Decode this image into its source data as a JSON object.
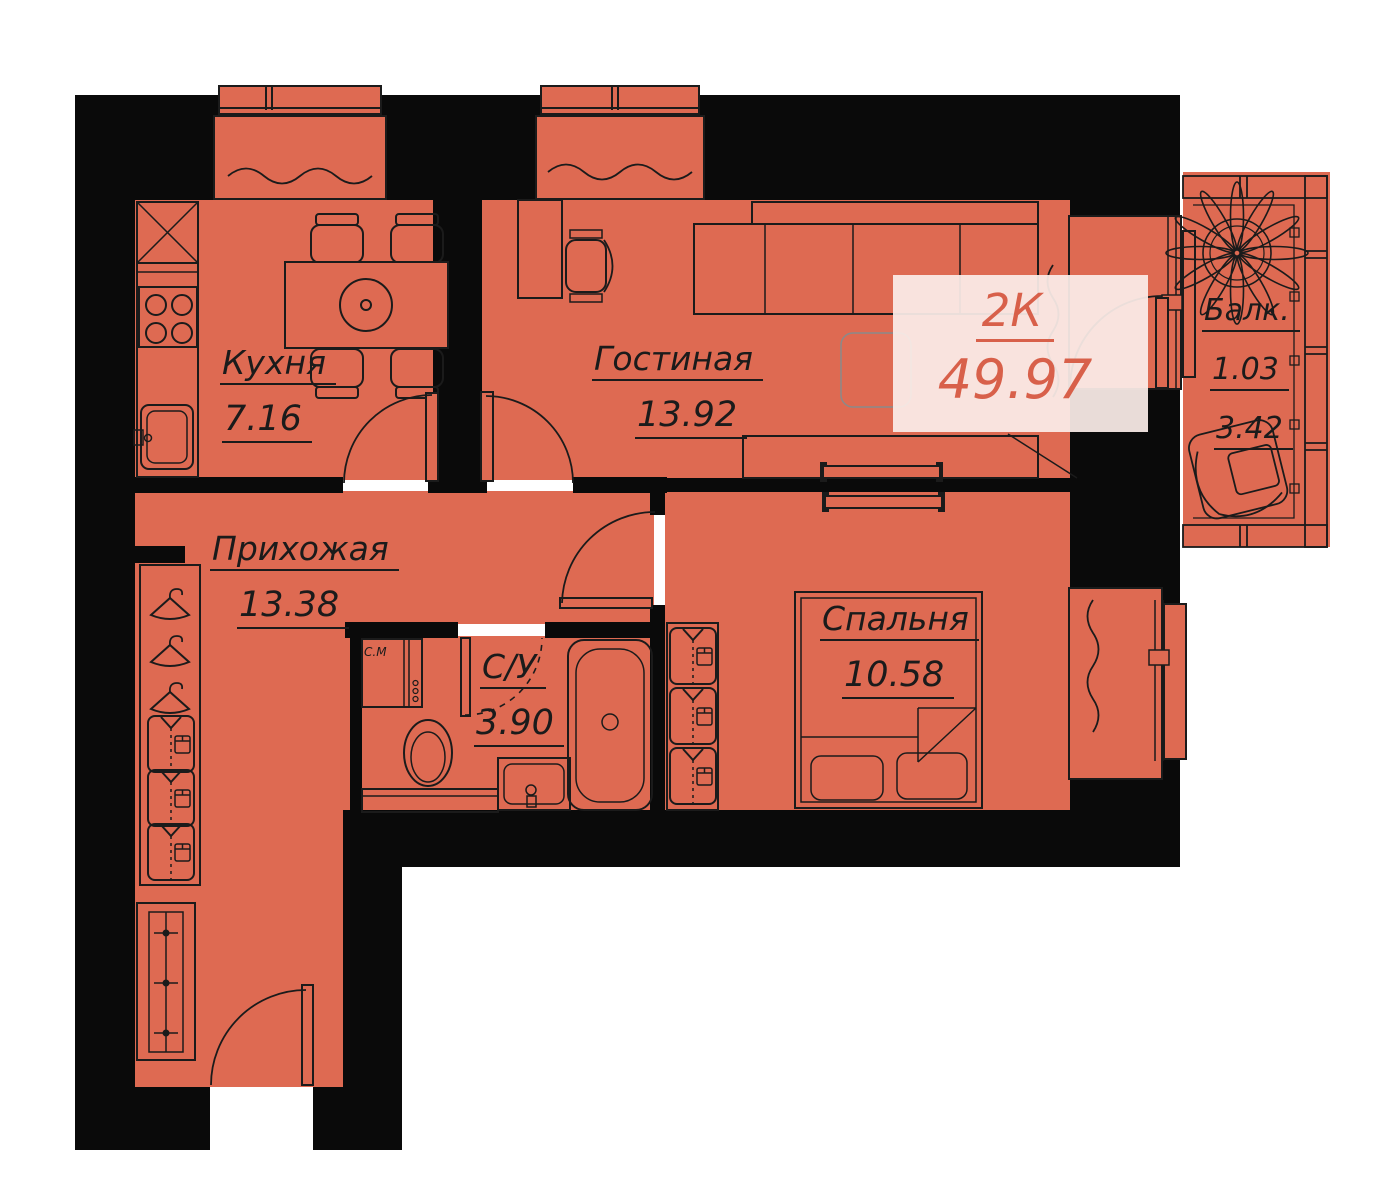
{
  "plan": {
    "unit": {
      "type_label": "2К",
      "total_area": "49.97"
    },
    "rooms": {
      "kitchen": {
        "name": "Кухня",
        "area": "7.16"
      },
      "living": {
        "name": "Гостиная",
        "area": "13.92"
      },
      "hallway": {
        "name": "Прихожая",
        "area": "13.38"
      },
      "bathroom": {
        "name": "С/У",
        "area": "3.90"
      },
      "bedroom": {
        "name": "Спальня",
        "area": "10.58"
      },
      "balcony": {
        "name": "Балк.",
        "reduced_area": "1.03",
        "full_area": "3.42"
      }
    },
    "appliances": {
      "washing_machine_label": "С.М"
    },
    "colors": {
      "floor": "#DE6A52",
      "wall": "#0A0A0A",
      "line": "#1B1B1B",
      "accent": "#D8604A",
      "accent_bg": "rgba(251,237,232,0.93)"
    }
  }
}
